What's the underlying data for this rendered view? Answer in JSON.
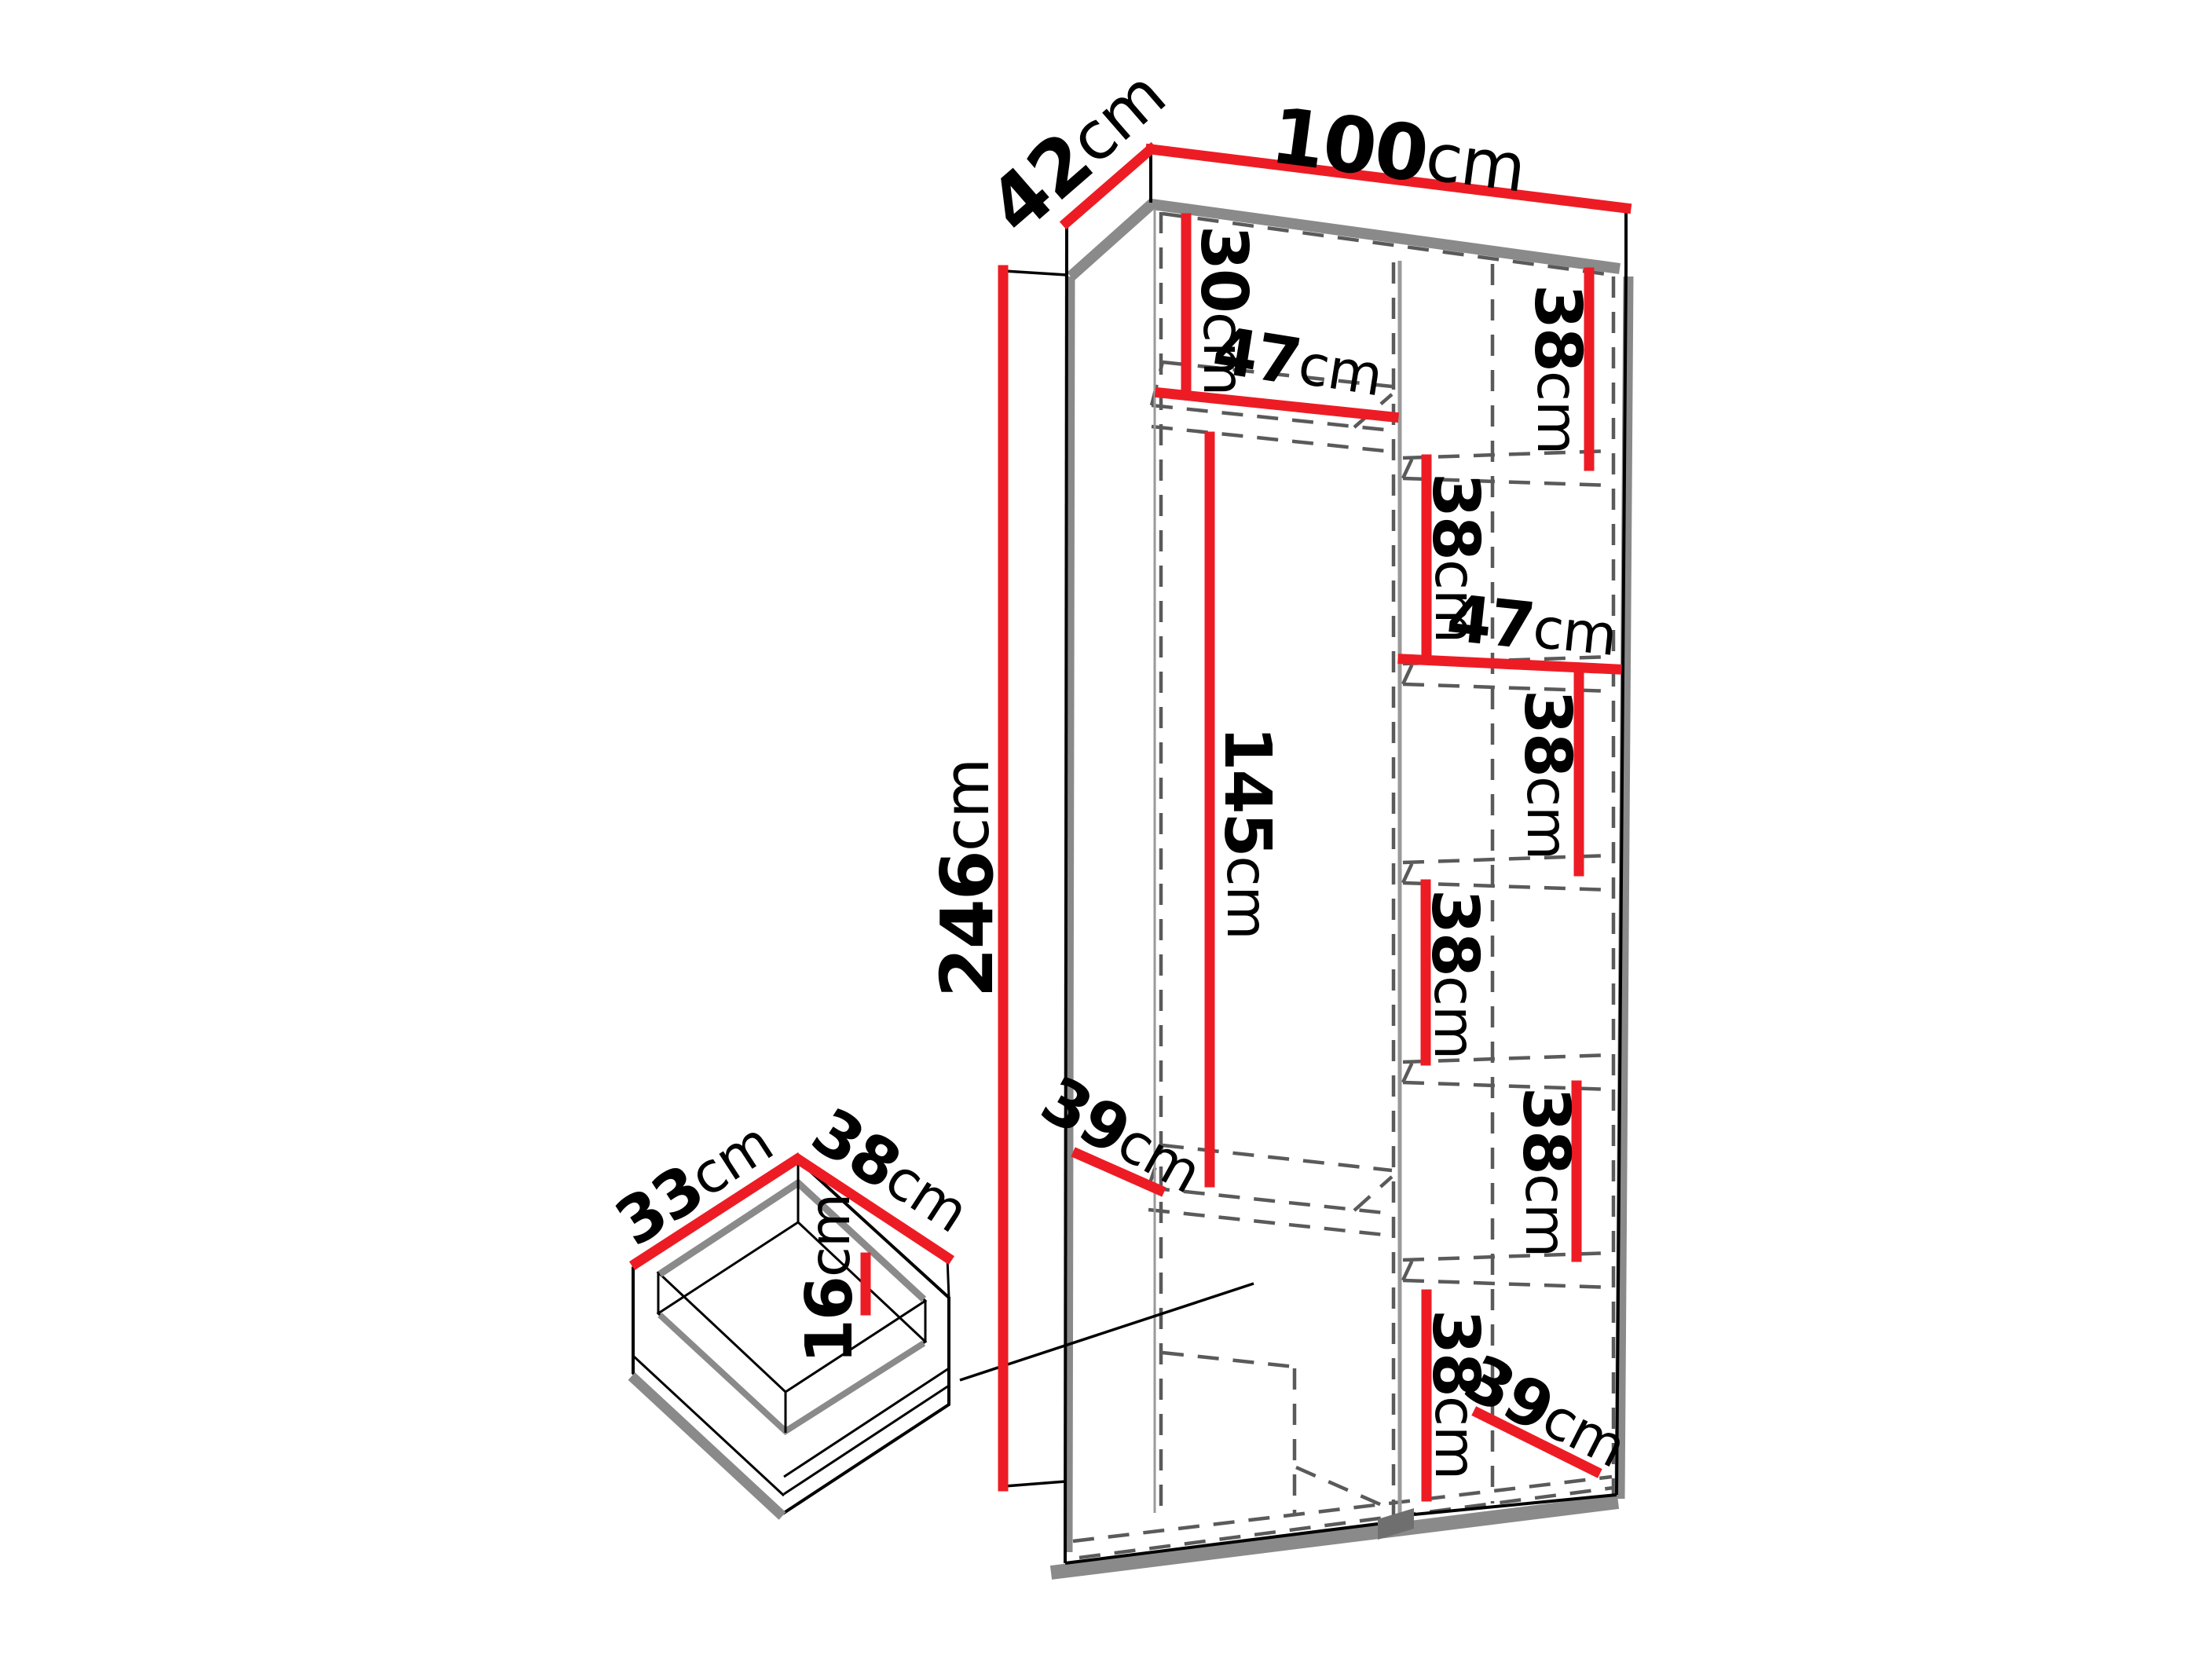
{
  "diagram_type": "furniture-dimension-drawing",
  "unit": "cm",
  "colors": {
    "dimension": "#ed1c24",
    "outline": "#000000",
    "shadow": "#8a8a8a",
    "dashed": "#5a5a5a",
    "partition": "#9a9a9a",
    "notch": "#6f6f6f",
    "bg": "#ffffff"
  },
  "labels": {
    "width_top": {
      "num": "100",
      "unit": "cm"
    },
    "depth_top": {
      "num": "42",
      "unit": "cm"
    },
    "height_left": {
      "num": "246",
      "unit": "cm"
    },
    "top_shelf": {
      "num": "30",
      "unit": "cm"
    },
    "hanging_width": {
      "num": "47",
      "unit": "cm"
    },
    "hanging_height": {
      "num": "145",
      "unit": "cm"
    },
    "left_bottom": {
      "num": "39",
      "unit": "cm"
    },
    "cubby_width": {
      "num": "47",
      "unit": "cm"
    },
    "right_bottom": {
      "num": "39",
      "unit": "cm"
    },
    "cubby_cells": [
      {
        "num": "38",
        "unit": "cm"
      },
      {
        "num": "38",
        "unit": "cm"
      },
      {
        "num": "38",
        "unit": "cm"
      },
      {
        "num": "38",
        "unit": "cm"
      },
      {
        "num": "38",
        "unit": "cm"
      },
      {
        "num": "38",
        "unit": "cm"
      }
    ],
    "drawer_depth": {
      "num": "33",
      "unit": "cm"
    },
    "drawer_width": {
      "num": "38",
      "unit": "cm"
    },
    "drawer_height": {
      "num": "16",
      "unit": "cm"
    }
  }
}
